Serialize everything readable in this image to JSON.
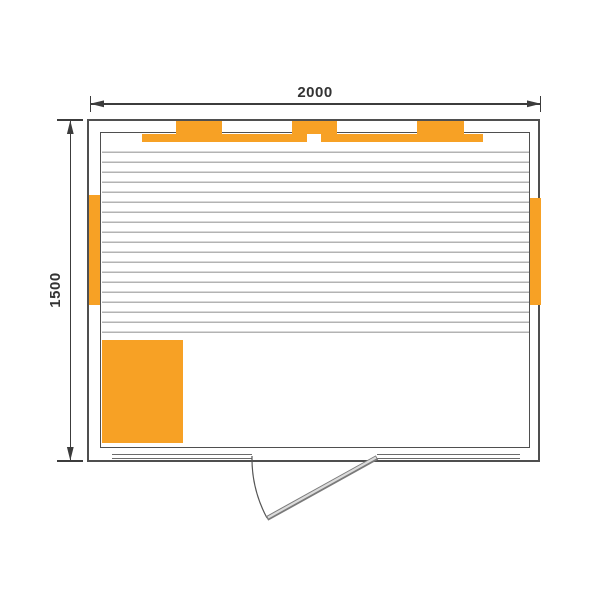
{
  "diagram": {
    "kind": "floor-plan-top-view",
    "dimensions": {
      "width_label": "2000",
      "height_label": "1500"
    },
    "elements": {
      "top_vents": 3,
      "heater_panel_strips": [
        "top-left",
        "top-right",
        "left-wall",
        "right-wall"
      ],
      "corner_heater_box": "bottom-left",
      "bench_slats_area": "upper-room",
      "door": "bottom-center, hinged right, swings outward"
    },
    "colors": {
      "heater_orange": "#F7A125",
      "wall_line": "#4f4f4f",
      "slat_line": "#b3b3b3",
      "dimension_line": "#3c3c3c",
      "background": "#ffffff"
    }
  }
}
